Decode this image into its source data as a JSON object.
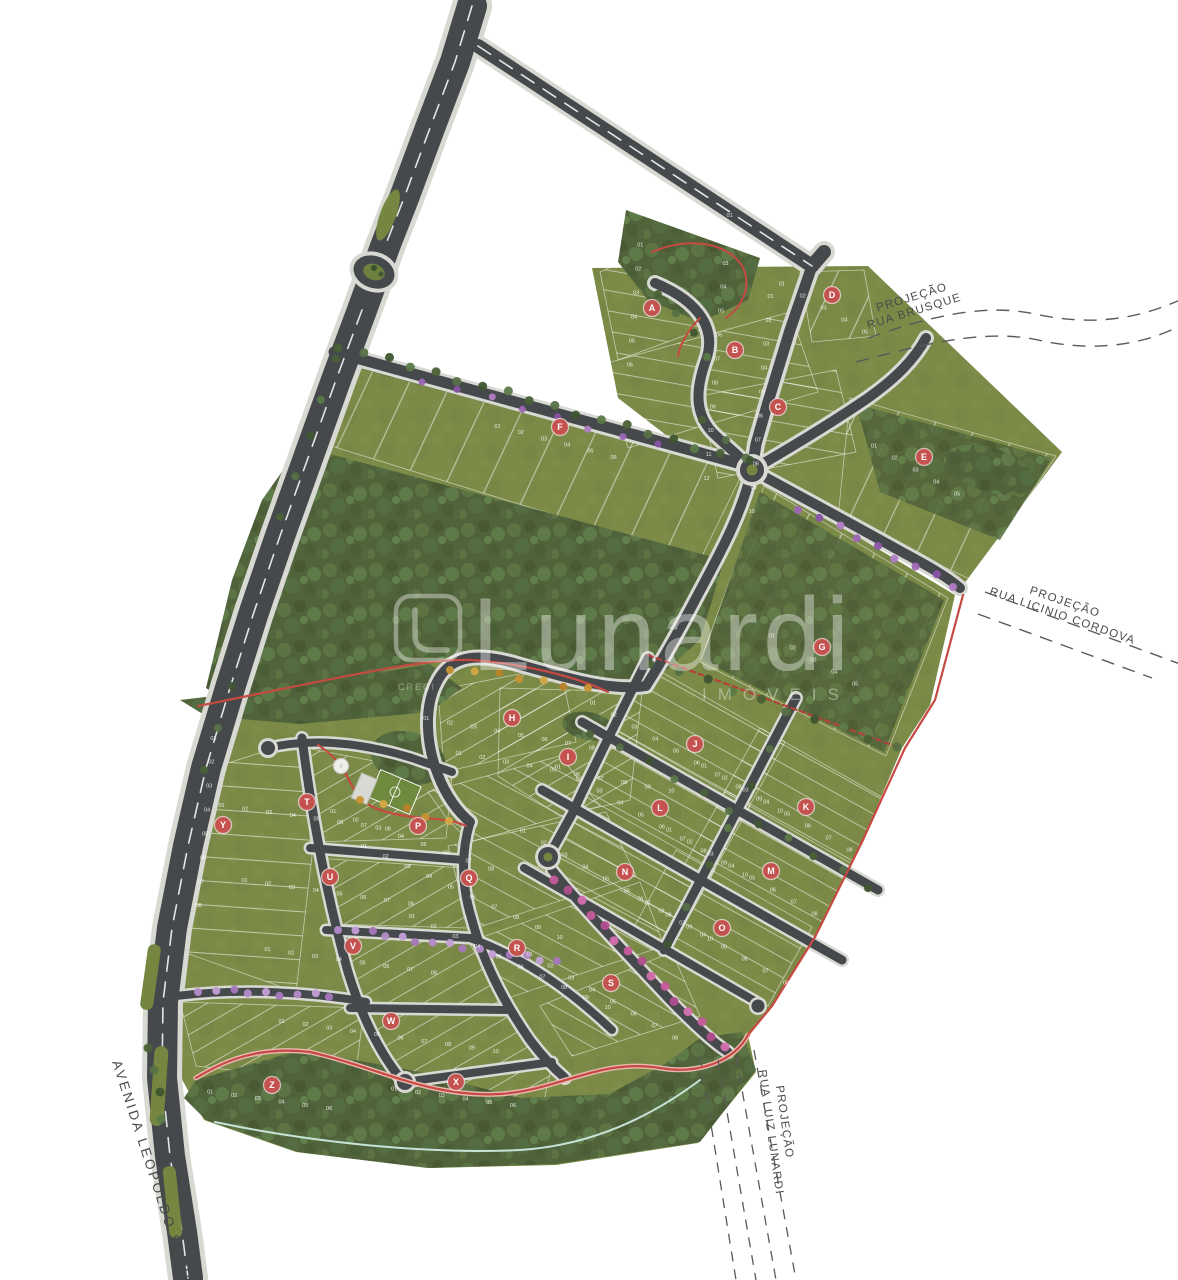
{
  "map": {
    "watermark": {
      "brand": "Lunardi",
      "suffix": "IMÓVEIS",
      "creci": "CRECI"
    },
    "labels": {
      "avenue": "AVENIDA LEOPOLDO SANDER",
      "projections": [
        {
          "line1": "PROJEÇÃO",
          "line2": "RUA BRUSQUE"
        },
        {
          "line1": "PROJEÇÃO",
          "line2": "RUA  LICINIO CORDOVA"
        },
        {
          "line1": "PROJEÇÃO",
          "line2": "RUA LUIZ LUNARDI"
        }
      ]
    },
    "lot_number_format": "01",
    "blocks": [
      {
        "label": "A",
        "x": 652,
        "y": 308,
        "lots": 6,
        "rowAngle": 95
      },
      {
        "label": "B",
        "x": 735,
        "y": 350,
        "lots": 12,
        "rowAngle": 95
      },
      {
        "label": "C",
        "x": 778,
        "y": 407,
        "lots": 10,
        "rowAngle": 95
      },
      {
        "label": "D",
        "x": 832,
        "y": 295,
        "lots": 5,
        "rowAngle": 30
      },
      {
        "label": "E",
        "x": 924,
        "y": 457,
        "lots": 5,
        "rowAngle": 30
      },
      {
        "label": "F",
        "x": 560,
        "y": 427,
        "lots": 6,
        "rowAngle": 15
      },
      {
        "label": "G",
        "x": 822,
        "y": 647,
        "lots": 5,
        "rowAngle": 30
      },
      {
        "label": "H",
        "x": 512,
        "y": 718,
        "lots": 8,
        "rowAngle": 10
      },
      {
        "label": "I",
        "x": 568,
        "y": 757,
        "lots": 10,
        "rowAngle": 10
      },
      {
        "label": "J",
        "x": 695,
        "y": 744,
        "lots": 10,
        "rowAngle": 30
      },
      {
        "label": "K",
        "x": 806,
        "y": 807,
        "lots": 10,
        "rowAngle": 30
      },
      {
        "label": "L",
        "x": 660,
        "y": 808,
        "lots": 10,
        "rowAngle": 30
      },
      {
        "label": "M",
        "x": 771,
        "y": 871,
        "lots": 10,
        "rowAngle": 30
      },
      {
        "label": "N",
        "x": 625,
        "y": 872,
        "lots": 10,
        "rowAngle": 30
      },
      {
        "label": "O",
        "x": 722,
        "y": 928,
        "lots": 8,
        "rowAngle": 30
      },
      {
        "label": "P",
        "x": 418,
        "y": 826,
        "lots": 8,
        "rowAngle": 20
      },
      {
        "label": "Q",
        "x": 469,
        "y": 878,
        "lots": 10,
        "rowAngle": 25
      },
      {
        "label": "R",
        "x": 517,
        "y": 948,
        "lots": 10,
        "rowAngle": 25
      },
      {
        "label": "S",
        "x": 611,
        "y": 983,
        "lots": 8,
        "rowAngle": 30
      },
      {
        "label": "T",
        "x": 307,
        "y": 802,
        "lots": 8,
        "rowAngle": 8
      },
      {
        "label": "U",
        "x": 330,
        "y": 877,
        "lots": 8,
        "rowAngle": 8
      },
      {
        "label": "V",
        "x": 353,
        "y": 946,
        "lots": 8,
        "rowAngle": 8
      },
      {
        "label": "W",
        "x": 391,
        "y": 1021,
        "lots": 10,
        "rowAngle": 8
      },
      {
        "label": "X",
        "x": 456,
        "y": 1082,
        "lots": 6,
        "rowAngle": 8
      },
      {
        "label": "Y",
        "x": 223,
        "y": 825,
        "lots": 8,
        "rowAngle": 95
      },
      {
        "label": "Z",
        "x": 272,
        "y": 1085,
        "lots": 6,
        "rowAngle": 8
      }
    ],
    "colors": {
      "badge": "#c4524e",
      "road": "#45494b",
      "sidewalk": "#d9d9d3",
      "lawn": "#7b8a47",
      "forest": "#51633a",
      "boundary_red": "#c64a42",
      "projection_line": "#5a5a5a",
      "label_text": "#4a4a4a"
    }
  }
}
